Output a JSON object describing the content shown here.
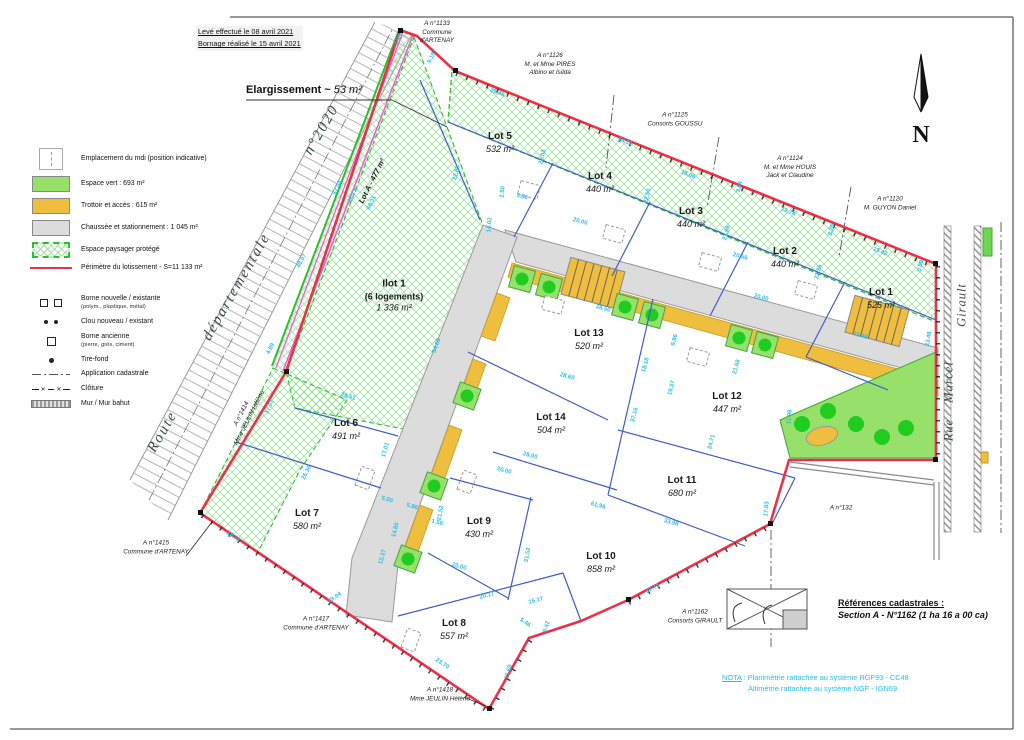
{
  "notes": {
    "line1": "Levé effectué le 08 avril 2021",
    "line2": "Bornage réalisé le 15 avril 2021"
  },
  "elargissement": {
    "bold": "Elargissement ~",
    "italic": " 53 m²"
  },
  "legend": {
    "areas": [
      {
        "label": "Emplacement du mdi (position indicative)"
      },
      {
        "label": "Espace vert : 693 m²"
      },
      {
        "label": "Trottoir et accès : 615 m²"
      },
      {
        "label": "Chaussée et stationnement : 1 045 m²"
      },
      {
        "label": "Espace paysager protégé"
      },
      {
        "label": "Périmètre du lotissement - S=11 133 m²"
      }
    ],
    "symbols": [
      {
        "label": "Borne nouvelle / existante",
        "sub": "(polym., plastique, métal)"
      },
      {
        "label": "Clou nouveau / existant",
        "sub": ""
      },
      {
        "label": "Borne ancienne",
        "sub": "(pierre, grès, ciment)"
      },
      {
        "label": "Tire-fond",
        "sub": ""
      },
      {
        "label": "Application cadastrale",
        "sub": ""
      },
      {
        "label": "Clôture",
        "sub": ""
      },
      {
        "label": "Mur / Mur bahut",
        "sub": ""
      }
    ]
  },
  "references": {
    "title": "Références cadastrales :",
    "line": "Section A - N°1162 (1 ha 16 a 00 ca)"
  },
  "nota": {
    "label": "NOTA",
    "line1": " : Planimétrie rattachée au système RGF93 - CC48",
    "line2": "Altimétrie rattachée au système NGF - IGN69"
  },
  "north": {
    "label": "N"
  },
  "colors": {
    "perimeter_red": "#E73247",
    "lot_line_blue": "#3E5EC8",
    "dim_cyan": "#2ABEE6",
    "green_space": "#97E06A",
    "tree_green": "#1FCC1F",
    "path_yellow": "#EFBE3F",
    "road_gray": "#DCDCDC",
    "strip_magenta": "#EE5FD6",
    "hatch_green": "#55CF5A"
  },
  "streets": {
    "route": [
      {
        "t": "Route",
        "x": 163,
        "y": 432,
        "r": -60
      },
      {
        "t": "départementale",
        "x": 237,
        "y": 287,
        "r": -60
      },
      {
        "t": "n°2020",
        "x": 322,
        "y": 130,
        "r": -60
      }
    ],
    "rue": [
      {
        "t": "Girault",
        "x": 962,
        "y": 305,
        "r": -90
      },
      {
        "t": "Marcel",
        "x": 949,
        "y": 382,
        "r": -90
      },
      {
        "t": "Rue",
        "x": 949,
        "y": 430,
        "r": -90
      }
    ]
  },
  "lots": [
    {
      "name": "Lot 5",
      "area": "532 m²",
      "x": 500,
      "y": 143
    },
    {
      "name": "Lot 4",
      "area": "440 m²",
      "x": 600,
      "y": 183
    },
    {
      "name": "Lot 3",
      "area": "440 m²",
      "x": 691,
      "y": 218
    },
    {
      "name": "Lot 2",
      "area": "440 m²",
      "x": 785,
      "y": 258
    },
    {
      "name": "Lot 1",
      "area": "525 m²",
      "x": 881,
      "y": 299
    },
    {
      "name": "Ilot 1",
      "sub": "(6 logements)",
      "area": "1 336 m²",
      "x": 394,
      "y": 296
    },
    {
      "name": "Lot 13",
      "area": "520 m²",
      "x": 589,
      "y": 340
    },
    {
      "name": "Lot 14",
      "area": "504 m²",
      "x": 551,
      "y": 424
    },
    {
      "name": "Lot 12",
      "area": "447 m²",
      "x": 727,
      "y": 403
    },
    {
      "name": "Lot 11",
      "area": "680 m²",
      "x": 682,
      "y": 487
    },
    {
      "name": "Lot 6",
      "area": "491 m²",
      "x": 346,
      "y": 430
    },
    {
      "name": "Lot 7",
      "area": "580 m²",
      "x": 307,
      "y": 520
    },
    {
      "name": "Lot 9",
      "area": "430 m²",
      "x": 479,
      "y": 528
    },
    {
      "name": "Lot 10",
      "area": "858 m²",
      "x": 601,
      "y": 563
    },
    {
      "name": "Lot 8",
      "area": "557 m²",
      "x": 454,
      "y": 630
    },
    {
      "name": "Lot A - 477 m²",
      "single": true,
      "x": 372,
      "y": 181,
      "r": -63
    }
  ],
  "neighbors": [
    {
      "lines": [
        "A n°1133",
        "Commune",
        "d'ARTENAY"
      ],
      "x": 437,
      "y": 33,
      "r": 0
    },
    {
      "lines": [
        "A n°1126",
        "M. et Mme PIRES",
        "Albino et Isilda"
      ],
      "x": 550,
      "y": 65,
      "r": 0
    },
    {
      "lines": [
        "A n°1125",
        "Consorts GOUSSU"
      ],
      "x": 675,
      "y": 120,
      "r": 0
    },
    {
      "lines": [
        "A n°1124",
        "M. et Mme HOUIS",
        "Jack et Claudine"
      ],
      "x": 790,
      "y": 168,
      "r": 0
    },
    {
      "lines": [
        "A n°1120",
        "M. GUYON Daniel"
      ],
      "x": 890,
      "y": 204,
      "r": 0
    },
    {
      "lines": [
        "A n°1414",
        "Mme JEULIN Hélène"
      ],
      "x": 246,
      "y": 416,
      "r": -63
    },
    {
      "lines": [
        "A n°1415",
        "Commune d'ARTENAY"
      ],
      "x": 156,
      "y": 548,
      "r": 0
    },
    {
      "lines": [
        "A n°1417",
        "Commune d'ARTENAY"
      ],
      "x": 316,
      "y": 624,
      "r": 0
    },
    {
      "lines": [
        "A n°1418",
        "Mme JEULIN Hélène"
      ],
      "x": 440,
      "y": 695,
      "r": 0
    },
    {
      "lines": [
        "A n°1162",
        "Consorts GIRAULT"
      ],
      "x": 695,
      "y": 617,
      "r": 0
    },
    {
      "lines": [
        "A n°132"
      ],
      "x": 841,
      "y": 509,
      "r": 0
    }
  ],
  "dimensions": [
    {
      "t": "1.90",
      "x": 399,
      "y": 40,
      "r": -63
    },
    {
      "t": "9.18",
      "x": 432,
      "y": 58,
      "r": -63
    },
    {
      "t": "25.46",
      "x": 497,
      "y": 93,
      "r": 22
    },
    {
      "t": "22.03",
      "x": 543,
      "y": 157,
      "r": -75
    },
    {
      "t": "22.83",
      "x": 457,
      "y": 173,
      "r": -75
    },
    {
      "t": "14.11",
      "x": 625,
      "y": 142,
      "r": 22
    },
    {
      "t": "18.06",
      "x": 688,
      "y": 175,
      "r": 22
    },
    {
      "t": "2.50",
      "x": 503,
      "y": 192,
      "r": -85
    },
    {
      "t": "5.86",
      "x": 522,
      "y": 197,
      "r": 15
    },
    {
      "t": "14.02",
      "x": 490,
      "y": 225,
      "r": -85
    },
    {
      "t": "20.00",
      "x": 580,
      "y": 222,
      "r": 15
    },
    {
      "t": "22.50",
      "x": 648,
      "y": 196,
      "r": -75
    },
    {
      "t": "20.56",
      "x": 740,
      "y": 257,
      "r": 15
    },
    {
      "t": "3.94",
      "x": 740,
      "y": 187,
      "r": -75
    },
    {
      "t": "12.74",
      "x": 788,
      "y": 212,
      "r": 22
    },
    {
      "t": "2.26",
      "x": 832,
      "y": 230,
      "r": -75
    },
    {
      "t": "19.42",
      "x": 880,
      "y": 252,
      "r": 22
    },
    {
      "t": "0.09",
      "x": 921,
      "y": 266,
      "r": -75
    },
    {
      "t": "21.98",
      "x": 727,
      "y": 233,
      "r": -75
    },
    {
      "t": "22.26",
      "x": 819,
      "y": 272,
      "r": -75
    },
    {
      "t": "20.00",
      "x": 761,
      "y": 298,
      "r": 15
    },
    {
      "t": "23.46",
      "x": 860,
      "y": 336,
      "r": 15
    },
    {
      "t": "23.48",
      "x": 929,
      "y": 339,
      "r": -80
    },
    {
      "t": "67.04",
      "x": 338,
      "y": 188,
      "r": -63
    },
    {
      "t": "67.72",
      "x": 353,
      "y": 196,
      "r": -63
    },
    {
      "t": "68.31",
      "x": 372,
      "y": 203,
      "r": -63
    },
    {
      "t": "48.67",
      "x": 302,
      "y": 261,
      "r": -63
    },
    {
      "t": "4.89",
      "x": 271,
      "y": 349,
      "r": -63
    },
    {
      "t": "34.63",
      "x": 437,
      "y": 346,
      "r": -70
    },
    {
      "t": "28.50",
      "x": 603,
      "y": 309,
      "r": 15
    },
    {
      "t": "28.60",
      "x": 567,
      "y": 377,
      "r": 15
    },
    {
      "t": "18.18",
      "x": 646,
      "y": 365,
      "r": -75
    },
    {
      "t": "19.37",
      "x": 672,
      "y": 388,
      "r": -75
    },
    {
      "t": "21.68",
      "x": 737,
      "y": 367,
      "r": -75
    },
    {
      "t": "5.86",
      "x": 675,
      "y": 340,
      "r": -75
    },
    {
      "t": "37.16",
      "x": 635,
      "y": 415,
      "r": -75
    },
    {
      "t": "24.71",
      "x": 712,
      "y": 442,
      "r": -75
    },
    {
      "t": "11.98",
      "x": 790,
      "y": 417,
      "r": -85
    },
    {
      "t": "17.83",
      "x": 767,
      "y": 509,
      "r": -85
    },
    {
      "t": "28.51",
      "x": 348,
      "y": 397,
      "r": 15
    },
    {
      "t": "17.07",
      "x": 270,
      "y": 407,
      "r": -63
    },
    {
      "t": "26.36",
      "x": 307,
      "y": 473,
      "r": -63
    },
    {
      "t": "17.01",
      "x": 386,
      "y": 450,
      "r": -75
    },
    {
      "t": "5.00",
      "x": 387,
      "y": 500,
      "r": 15
    },
    {
      "t": "5.86",
      "x": 412,
      "y": 507,
      "r": 15
    },
    {
      "t": "1.50",
      "x": 437,
      "y": 523,
      "r": 15
    },
    {
      "t": "14.80",
      "x": 396,
      "y": 530,
      "r": -75
    },
    {
      "t": "12.37",
      "x": 383,
      "y": 557,
      "r": -75
    },
    {
      "t": "28.00",
      "x": 530,
      "y": 456,
      "r": 15
    },
    {
      "t": "20.00",
      "x": 504,
      "y": 471,
      "r": 15
    },
    {
      "t": "61.96",
      "x": 598,
      "y": 506,
      "r": 15
    },
    {
      "t": "33.98",
      "x": 671,
      "y": 523,
      "r": 15
    },
    {
      "t": "21.52",
      "x": 441,
      "y": 513,
      "r": -80
    },
    {
      "t": "31.52",
      "x": 528,
      "y": 555,
      "r": -80
    },
    {
      "t": "20.00",
      "x": 459,
      "y": 567,
      "r": 15
    },
    {
      "t": "20.17",
      "x": 487,
      "y": 596,
      "r": -15
    },
    {
      "t": "15.17",
      "x": 536,
      "y": 601,
      "r": -15
    },
    {
      "t": "37.71",
      "x": 653,
      "y": 589,
      "r": -28
    },
    {
      "t": "29.04",
      "x": 335,
      "y": 598,
      "r": -35
    },
    {
      "t": "23.70",
      "x": 442,
      "y": 664,
      "r": 33
    },
    {
      "t": "9.42",
      "x": 547,
      "y": 627,
      "r": -72
    },
    {
      "t": "15.69",
      "x": 509,
      "y": 672,
      "r": -75
    },
    {
      "t": "5.46",
      "x": 525,
      "y": 623,
      "r": 33
    },
    {
      "t": "18.78",
      "x": 233,
      "y": 537,
      "r": 35
    }
  ]
}
